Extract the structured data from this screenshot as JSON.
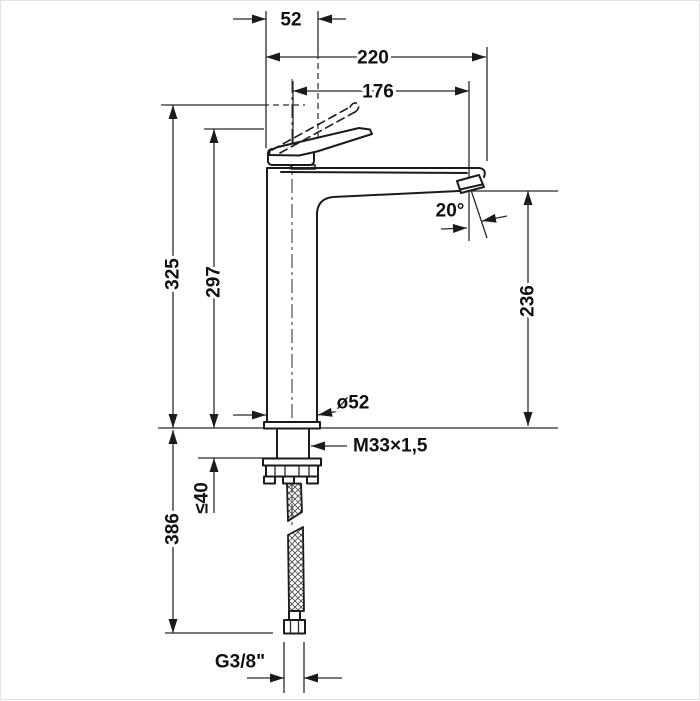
{
  "dimensions": {
    "spout_top_width": "52",
    "total_depth": "220",
    "spout_reach": "176",
    "total_height": "325",
    "handle_height": "297",
    "outlet_height": "236",
    "spray_angle": "20°",
    "body_diameter": "ø52",
    "mounting_thread": "M33×1,5",
    "max_mounting_thickness": "≤40",
    "supply_hose_length": "386",
    "supply_connection": "G3/8\""
  }
}
